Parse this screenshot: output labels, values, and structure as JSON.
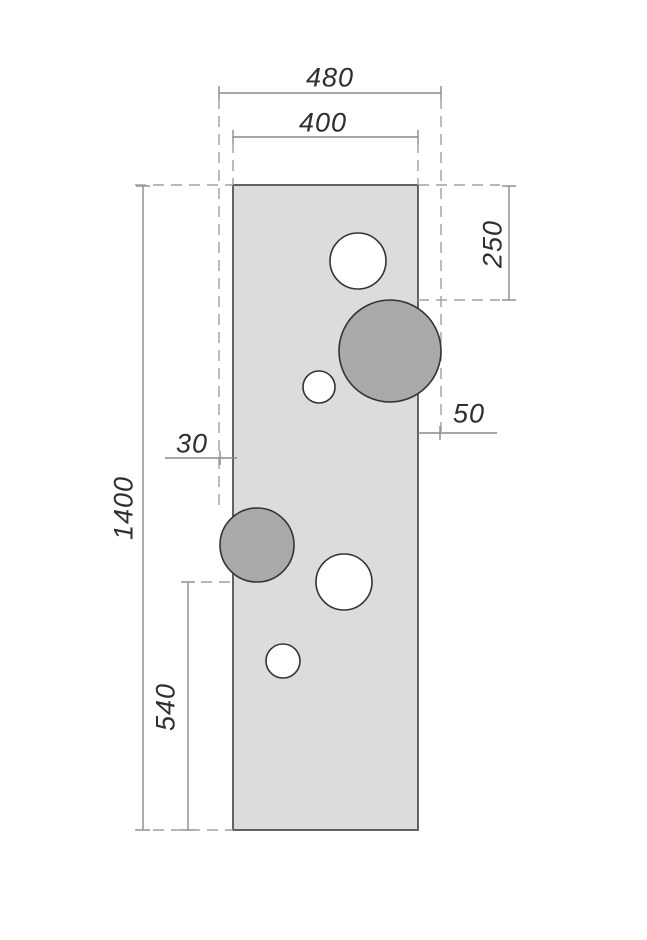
{
  "drawing": {
    "type": "technical-dimension-drawing",
    "canvas": {
      "width": 647,
      "height": 940,
      "background": "#ffffff"
    },
    "colors": {
      "panel_fill": "#dcdcdc",
      "panel_stroke": "#4a4a4a",
      "hole_fill": "#ffffff",
      "filled_circle_fill": "#a9a9a9",
      "circle_stroke": "#333333",
      "dimension_line": "#8a8a8a",
      "dashed_guide": "#a0a0a0",
      "label_text": "#2f2f2f"
    },
    "panel": {
      "x": 233,
      "y": 185,
      "width": 185,
      "height": 645
    },
    "circles": [
      {
        "cx": 358,
        "cy": 261,
        "r": 28,
        "type": "open"
      },
      {
        "cx": 390,
        "cy": 351,
        "r": 51,
        "type": "filled"
      },
      {
        "cx": 319,
        "cy": 387,
        "r": 16,
        "type": "open"
      },
      {
        "cx": 257,
        "cy": 545,
        "r": 37,
        "type": "filled"
      },
      {
        "cx": 344,
        "cy": 582,
        "r": 28,
        "type": "open"
      },
      {
        "cx": 283,
        "cy": 661,
        "r": 17,
        "type": "open"
      }
    ],
    "dimensions": [
      {
        "label": "480",
        "value": 480,
        "orientation": "horizontal"
      },
      {
        "label": "400",
        "value": 400,
        "orientation": "horizontal"
      },
      {
        "label": "250",
        "value": 250,
        "orientation": "vertical"
      },
      {
        "label": "50",
        "value": 50,
        "orientation": "horizontal"
      },
      {
        "label": "30",
        "value": 30,
        "orientation": "horizontal"
      },
      {
        "label": "1400",
        "value": 1400,
        "orientation": "vertical"
      },
      {
        "label": "540",
        "value": 540,
        "orientation": "vertical"
      }
    ],
    "lines": [
      {
        "x1": 219,
        "y1": 93,
        "x2": 441,
        "y2": 93,
        "kind": "dim"
      },
      {
        "x1": 233,
        "y1": 137,
        "x2": 418,
        "y2": 137,
        "kind": "dim"
      },
      {
        "x1": 509,
        "y1": 186,
        "x2": 509,
        "y2": 300,
        "kind": "dim"
      },
      {
        "x1": 418,
        "y1": 433,
        "x2": 497,
        "y2": 433,
        "kind": "dim"
      },
      {
        "x1": 165,
        "y1": 458,
        "x2": 237,
        "y2": 458,
        "kind": "dim"
      },
      {
        "x1": 143,
        "y1": 186,
        "x2": 143,
        "y2": 830,
        "kind": "dim"
      },
      {
        "x1": 188,
        "y1": 582,
        "x2": 188,
        "y2": 830,
        "kind": "dim"
      },
      {
        "x1": 219,
        "y1": 86,
        "x2": 219,
        "y2": 100,
        "kind": "tick"
      },
      {
        "x1": 441,
        "y1": 86,
        "x2": 441,
        "y2": 100,
        "kind": "tick"
      },
      {
        "x1": 233,
        "y1": 130,
        "x2": 233,
        "y2": 144,
        "kind": "tick"
      },
      {
        "x1": 418,
        "y1": 130,
        "x2": 418,
        "y2": 144,
        "kind": "tick"
      },
      {
        "x1": 502,
        "y1": 186,
        "x2": 516,
        "y2": 186,
        "kind": "tick"
      },
      {
        "x1": 502,
        "y1": 300,
        "x2": 516,
        "y2": 300,
        "kind": "tick"
      },
      {
        "x1": 440,
        "y1": 426,
        "x2": 440,
        "y2": 440,
        "kind": "tick"
      },
      {
        "x1": 220,
        "y1": 451,
        "x2": 220,
        "y2": 465,
        "kind": "tick"
      },
      {
        "x1": 136,
        "y1": 186,
        "x2": 150,
        "y2": 186,
        "kind": "tick"
      },
      {
        "x1": 136,
        "y1": 830,
        "x2": 150,
        "y2": 830,
        "kind": "tick"
      },
      {
        "x1": 181,
        "y1": 582,
        "x2": 195,
        "y2": 582,
        "kind": "tick"
      },
      {
        "x1": 181,
        "y1": 830,
        "x2": 195,
        "y2": 830,
        "kind": "tick"
      },
      {
        "x1": 219,
        "y1": 98,
        "x2": 219,
        "y2": 508,
        "kind": "dash"
      },
      {
        "x1": 441,
        "y1": 98,
        "x2": 441,
        "y2": 433,
        "kind": "dash"
      },
      {
        "x1": 233,
        "y1": 142,
        "x2": 233,
        "y2": 185,
        "kind": "dash"
      },
      {
        "x1": 418,
        "y1": 142,
        "x2": 418,
        "y2": 185,
        "kind": "dash"
      },
      {
        "x1": 135,
        "y1": 185,
        "x2": 233,
        "y2": 185,
        "kind": "dash"
      },
      {
        "x1": 418,
        "y1": 185,
        "x2": 500,
        "y2": 185,
        "kind": "dash"
      },
      {
        "x1": 418,
        "y1": 300,
        "x2": 500,
        "y2": 300,
        "kind": "dash"
      },
      {
        "x1": 183,
        "y1": 582,
        "x2": 233,
        "y2": 582,
        "kind": "dash"
      },
      {
        "x1": 135,
        "y1": 830,
        "x2": 233,
        "y2": 830,
        "kind": "dash"
      }
    ]
  }
}
